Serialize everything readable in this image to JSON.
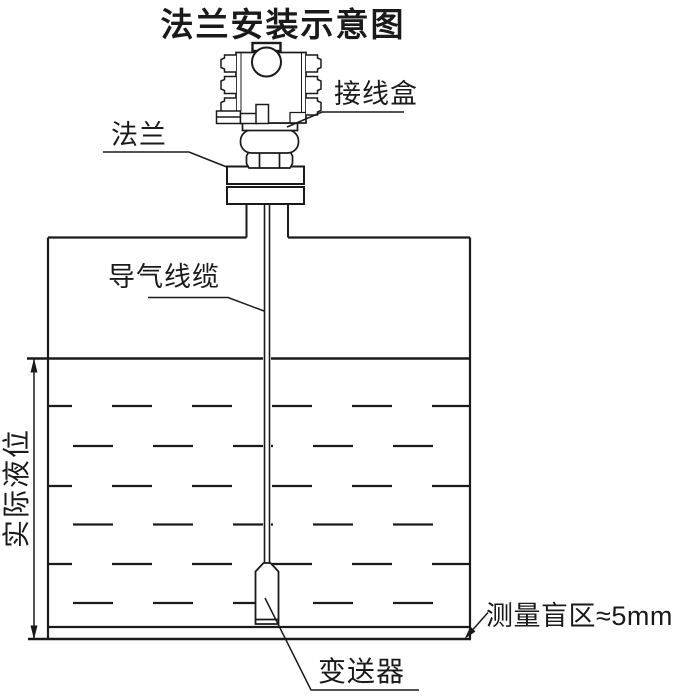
{
  "title": "法兰安装示意图",
  "labels": {
    "junction_box": "接线盒",
    "flange": "法兰",
    "air_cable": "导气线缆",
    "actual_level": "实际液位",
    "transmitter": "变送器",
    "blind_zone": "测量盲区≈5mm"
  },
  "colors": {
    "line": "#1a1a1a",
    "background": "#ffffff"
  }
}
